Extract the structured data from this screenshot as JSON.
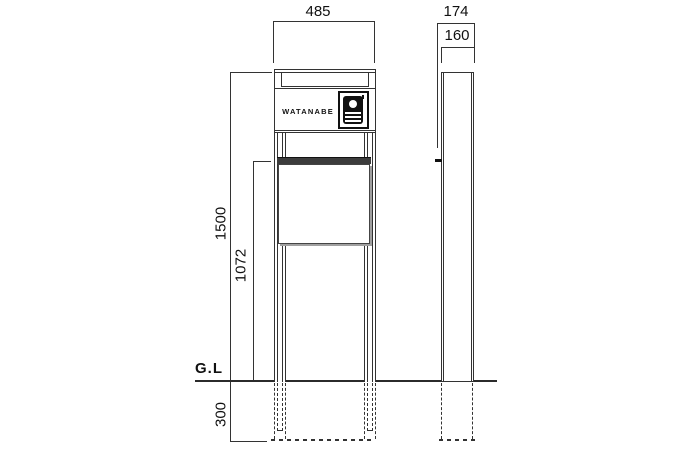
{
  "meta": {
    "type": "technical-drawing",
    "subject": "entrance function pole with intercom and mailbox, front and side elevations"
  },
  "labels": {
    "ground": "G.L",
    "nameplate": "WATANABE"
  },
  "dimensions": {
    "front_width": "485",
    "overall_depth": "174",
    "body_depth": "160",
    "overall_height": "1500",
    "mailbox_top_height": "1072",
    "embed_depth": "300"
  },
  "colors": {
    "line": "#333333",
    "text": "#111111",
    "door_band": "#3c3c3c",
    "shadow": "#a0a0a0",
    "background": "#ffffff"
  },
  "icons": {
    "intercom": "intercom-icon"
  }
}
